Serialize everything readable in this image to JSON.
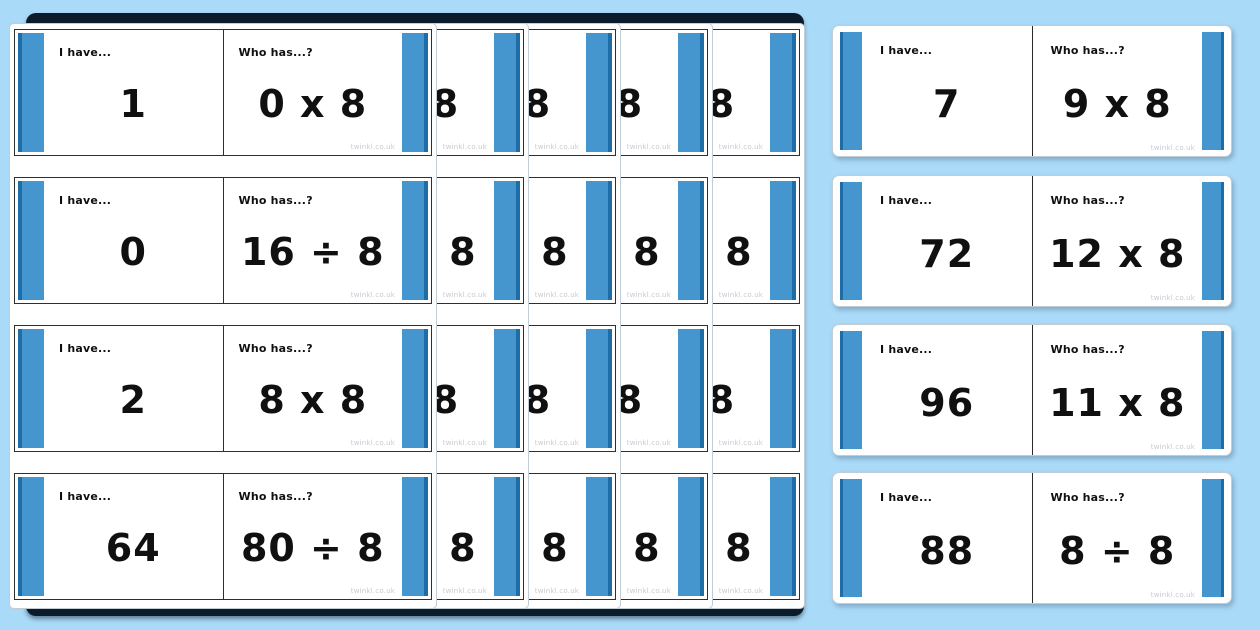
{
  "labels": {
    "i_have": "I have...",
    "who_has": "Who has...?"
  },
  "watermark": "twinkl.co.uk",
  "colors": {
    "background": "#a9daf7",
    "bar_blue": "#4595cf",
    "bar_blue_dark": "#1e6da6",
    "card_border": "#2f2f2f",
    "stack_shadow": "#0b1b2b",
    "page_white": "#ffffff"
  },
  "stack": {
    "page_count": 5,
    "page_offset_px": 92,
    "partial_glyph_on_hidden_pages": "8",
    "cards": [
      {
        "i_have": "1",
        "who_has": "0 x 8"
      },
      {
        "i_have": "0",
        "who_has": "16 ÷ 8"
      },
      {
        "i_have": "2",
        "who_has": "8 x 8"
      },
      {
        "i_have": "64",
        "who_has": "80 ÷ 8"
      }
    ]
  },
  "right_column": {
    "cards": [
      {
        "i_have": "7",
        "who_has": "9 x 8"
      },
      {
        "i_have": "72",
        "who_has": "12 x 8"
      },
      {
        "i_have": "96",
        "who_has": "11 x 8"
      },
      {
        "i_have": "88",
        "who_has": "8 ÷ 8"
      }
    ]
  }
}
